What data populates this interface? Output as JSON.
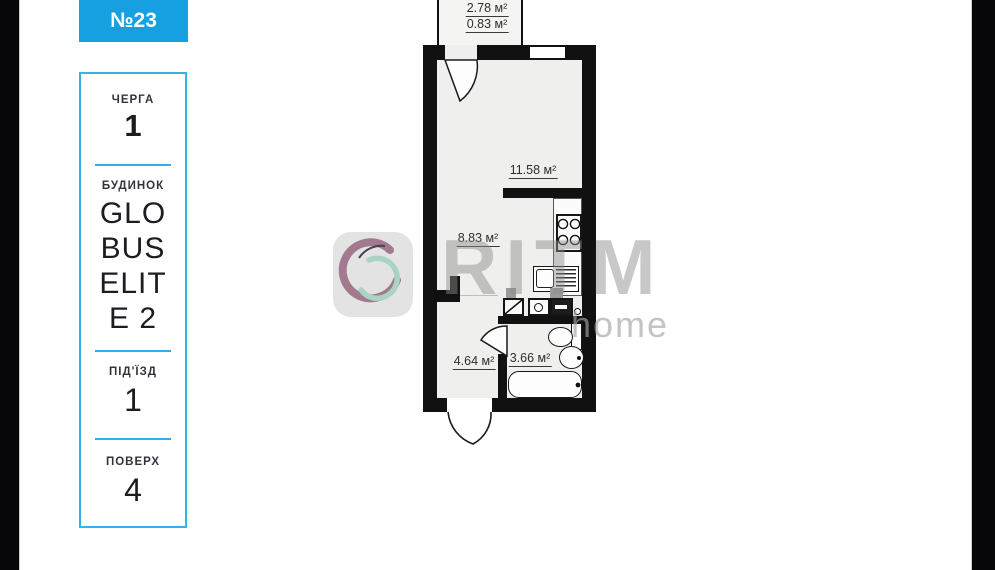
{
  "badge": {
    "number": "№23"
  },
  "panel": {
    "sections": [
      {
        "label": "ЧЕРГА",
        "value": "1"
      },
      {
        "label": "БУДИНОК",
        "value": "GLOBUS ELITE 2"
      },
      {
        "label": "ПІД'ЇЗД",
        "value": "1"
      },
      {
        "label": "ПОВЕРХ",
        "value": "4"
      }
    ]
  },
  "floorplan": {
    "rooms": [
      {
        "name": "balcony-total",
        "area": "2.78 м²"
      },
      {
        "name": "balcony-reduced",
        "area": "0.83 м²"
      },
      {
        "name": "living-room",
        "area": "11.58 м²"
      },
      {
        "name": "kitchen-zone",
        "area": "8.83 м²"
      },
      {
        "name": "hallway",
        "area": "4.64 м²"
      },
      {
        "name": "bathroom",
        "area": "3.66 м²"
      }
    ]
  },
  "watermark": {
    "brand": "RITM",
    "sub": "home",
    "logo": "ritm-swirl-logo"
  },
  "colors": {
    "accent_blue": "#17a0e1",
    "panel_border": "#35b2e6",
    "wall": "#111111",
    "floor": "#efefee",
    "logo_purple": "#a2798e",
    "logo_teal": "#a9d4c4"
  }
}
